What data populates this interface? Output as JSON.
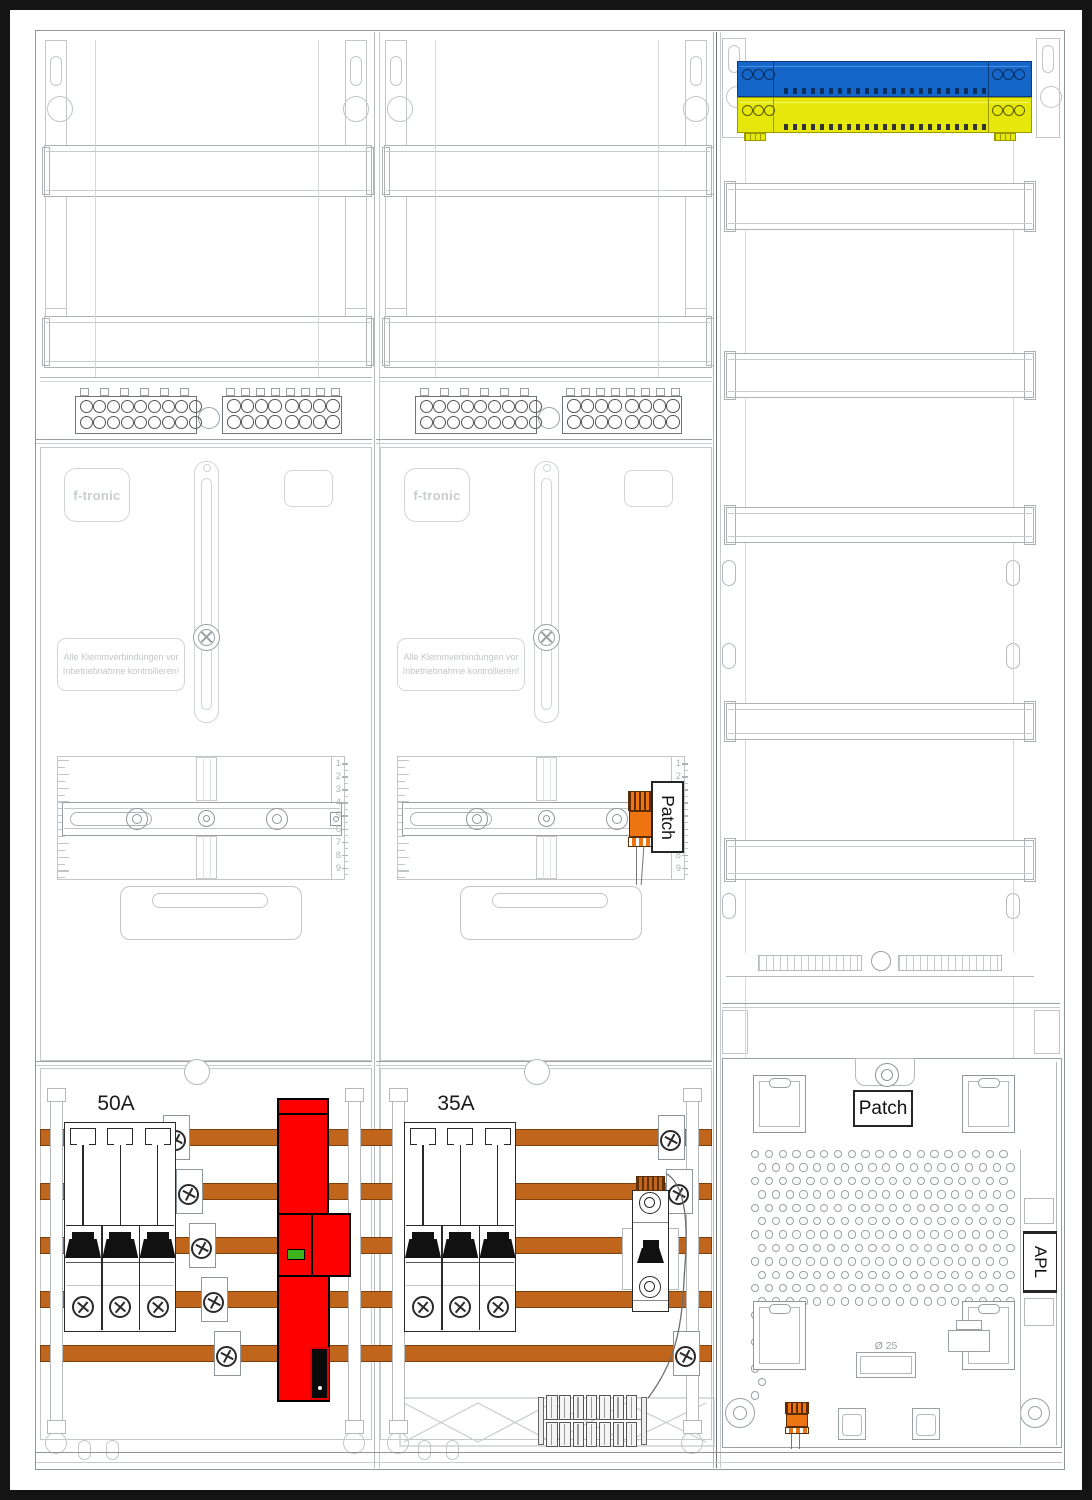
{
  "title": "meter-cabinet-wiring-diagram",
  "colors": {
    "busbar_copper": "#c0651c",
    "sls_red": "#ff0000",
    "patch_orange": "#ee7311",
    "neutral_blue": "#1467c8",
    "pe_yellow": "#e6e70a",
    "indicator_green": "#3db31e"
  },
  "left_column": {
    "brand": "f-tronic",
    "warning": "Alle Klemmverbindungen vor Inbetriebnahme kontrollieren!",
    "breaker_rating": "50A"
  },
  "middle_column": {
    "brand": "f-tronic",
    "warning": "Alle Klemmverbindungen vor Inbetriebnahme kontrollieren!",
    "breaker_rating": "35A",
    "patch_label": "Patch"
  },
  "right_column": {
    "patch_label": "Patch",
    "apl_label": "APL",
    "cable_gland_diameter": "Ø 25"
  },
  "meter_rail_scale": [
    "1",
    "2",
    "3",
    "4",
    "5",
    "6",
    "7",
    "8",
    "9"
  ]
}
